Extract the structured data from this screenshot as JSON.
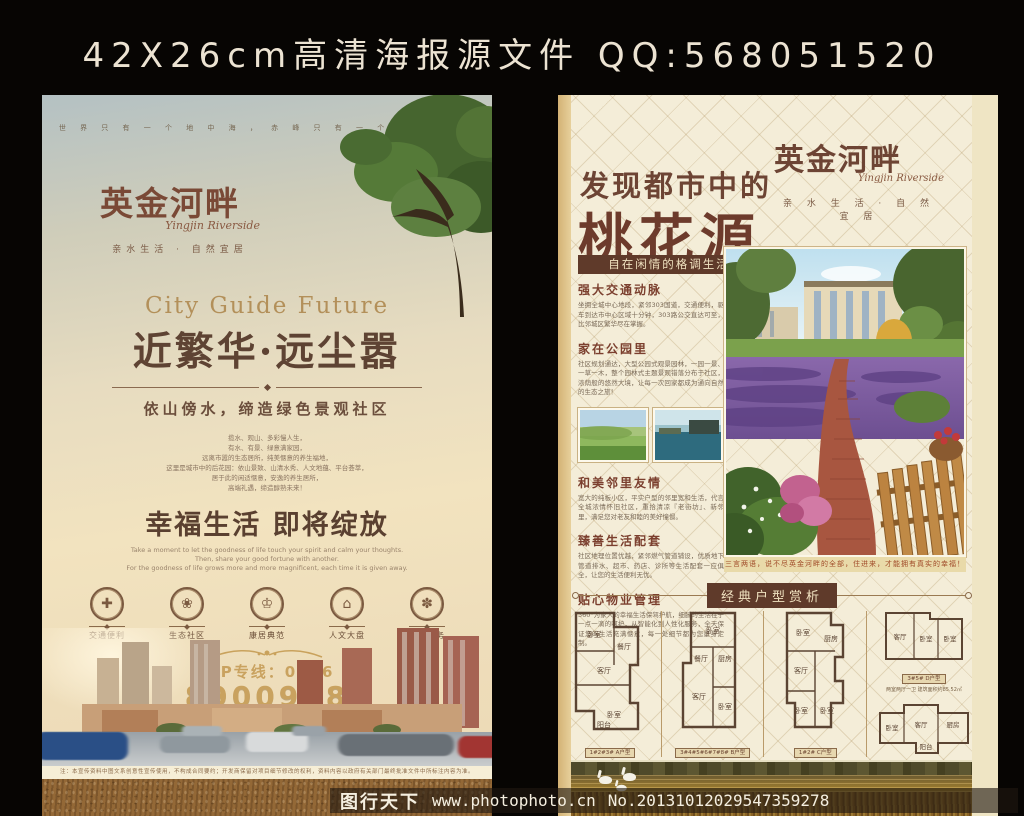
{
  "header": {
    "title": "42X26cm高清海报源文件 QQ:568051520"
  },
  "left_poster": {
    "top_slogan": "世 界 只 有 一 个 地 中 海 ， 赤 峰 只 有 一 个 英 金 河 畔",
    "logo": {
      "name": "英金河畔",
      "script": "Yingjin Riverside",
      "tagline": "亲水生活 · 自然宜居"
    },
    "headline_en": "City Guide Future",
    "headline": "近繁华·远尘嚣",
    "subhead": "依山傍水，缔造绿色景观社区",
    "poem": "揽水、观山、多彩慢人生，\n有水、有景、绿意满家园，\n远离市嚣的生态居所，纯美惬意的养生福地，\n这里是城市中的后花园：依山景致、山清水秀、人文地蕴、平台荟萃，\n居于此的闲适惬意，安逸的养生居所，\n高端礼遇，缔造醇熟未来！",
    "happy_title": "幸福生活 即将绽放",
    "happy_en": "Take a moment to let the goodness of life touch your spirit and calm your thoughts.\nThen, share your good fortune with another.\nFor the goodness of life grows more and more magnificent, each time it is given away.",
    "features": [
      {
        "icon": "medical-cross-icon",
        "glyph": "✚",
        "label": "交通便利"
      },
      {
        "icon": "leaf-icon",
        "glyph": "❀",
        "label": "生态社区"
      },
      {
        "icon": "crown-icon",
        "glyph": "♔",
        "label": "康居典范"
      },
      {
        "icon": "house-icon",
        "glyph": "⌂",
        "label": "人文大盘"
      },
      {
        "icon": "service-icon",
        "glyph": "✽",
        "label": "臻善服务"
      }
    ],
    "vip_label": "VIP专线：0476",
    "phone": "8900958",
    "developer_line": "开发商：赤峰鑫源房地产开发有限公司　　项目地址：赤峰市红山区红金大街",
    "disclaimer": "注：本宣传资料中图文系创意性宣传使用，不构成合同要约；开发商保留对项目细节修改的权利，资料内容以政府有关部门最终批准文件中所标注内容为准。"
  },
  "right_poster": {
    "logo": {
      "name": "英金河畔",
      "script": "Yingjin Riverside",
      "tagline": "亲 水 生 活 · 自 然 宜 居"
    },
    "headline_top": "发现都市中的",
    "headline_main": "桃花源",
    "banner": "自在闲情的格调生活",
    "sections": [
      {
        "heading": "强大交通动脉",
        "body": "坐拥全城中心地段，紧邻303国道，交通便利，驱车到达市中心区域十分钟，303路公交直达可至，比邻城区繁华尽在掌握。"
      },
      {
        "heading": "家在公园里",
        "body": "社区规划通达，大型公园式观景园林，一园一景、一草一木，整个园林式主题景观错落分布于社区，浓荫般的悠然大境，让每一次回家都成为通向自然的生态之旅！"
      },
      {
        "heading": "和美邻里友情",
        "body": "宽大的纯板小区，平实户型的邻里宽和生活，代言全城浓情怀旧社区，重拾清凉『老街坊』、新邻里，满足您对老友和睦的美好憧憬。"
      },
      {
        "heading": "臻善生活配套",
        "body": "社区地理位置优越，紧邻燃气管道铺设，优质地下管道排水、超市、药店、诊所等生活配套一应俱全，让您的生活便利无忧。"
      },
      {
        "heading": "贴心物业管理",
        "body": "360°为家人的幸福生活保驾护航，细腻的生活在于一点一滴的呵护，从智能化到人性化服务，全天保证您的生活充满惬意，每一处细节都为您量身定制。"
      }
    ],
    "photo_caption": "三言两语，说不尽英金河畔的全部，住进来，才能拥有真实的幸福！",
    "plans_title": "经典户型赏析",
    "plans": [
      {
        "caption": "1#2#3# A户型",
        "spec": "两室两厅一卫 建筑面积约90.21㎡",
        "rooms": [
          "卧室",
          "餐厅",
          "客厅",
          "卧室",
          "阳台"
        ]
      },
      {
        "caption": "3#4#5#6#7#8# B户型",
        "spec": "两室两厅一卫 建筑面积约97.76㎡",
        "rooms": [
          "卧室",
          "餐厅",
          "厨房",
          "客厅",
          "卧室"
        ]
      },
      {
        "caption": "1#2# C户型",
        "spec": "三室两厅两卫 建筑面积约121.36㎡",
        "rooms": [
          "卧室",
          "厨房",
          "客厅",
          "卧室",
          "卧室"
        ]
      },
      {
        "caption": "3#5# D户型",
        "spec": "两室两厅一卫 建筑面积约85.52㎡",
        "rooms": [
          "客厅",
          "卧室",
          "卧室"
        ]
      },
      {
        "caption": "2#4#6#8#10# E户型",
        "spec": "两室两厅一卫 建筑面积约91.78㎡",
        "rooms": [
          "卧室",
          "客厅",
          "厨房",
          "阳台"
        ]
      }
    ]
  },
  "watermark": {
    "site": "图行天下",
    "url": "www.photophoto.cn",
    "number": "No.20131012029547359278"
  }
}
